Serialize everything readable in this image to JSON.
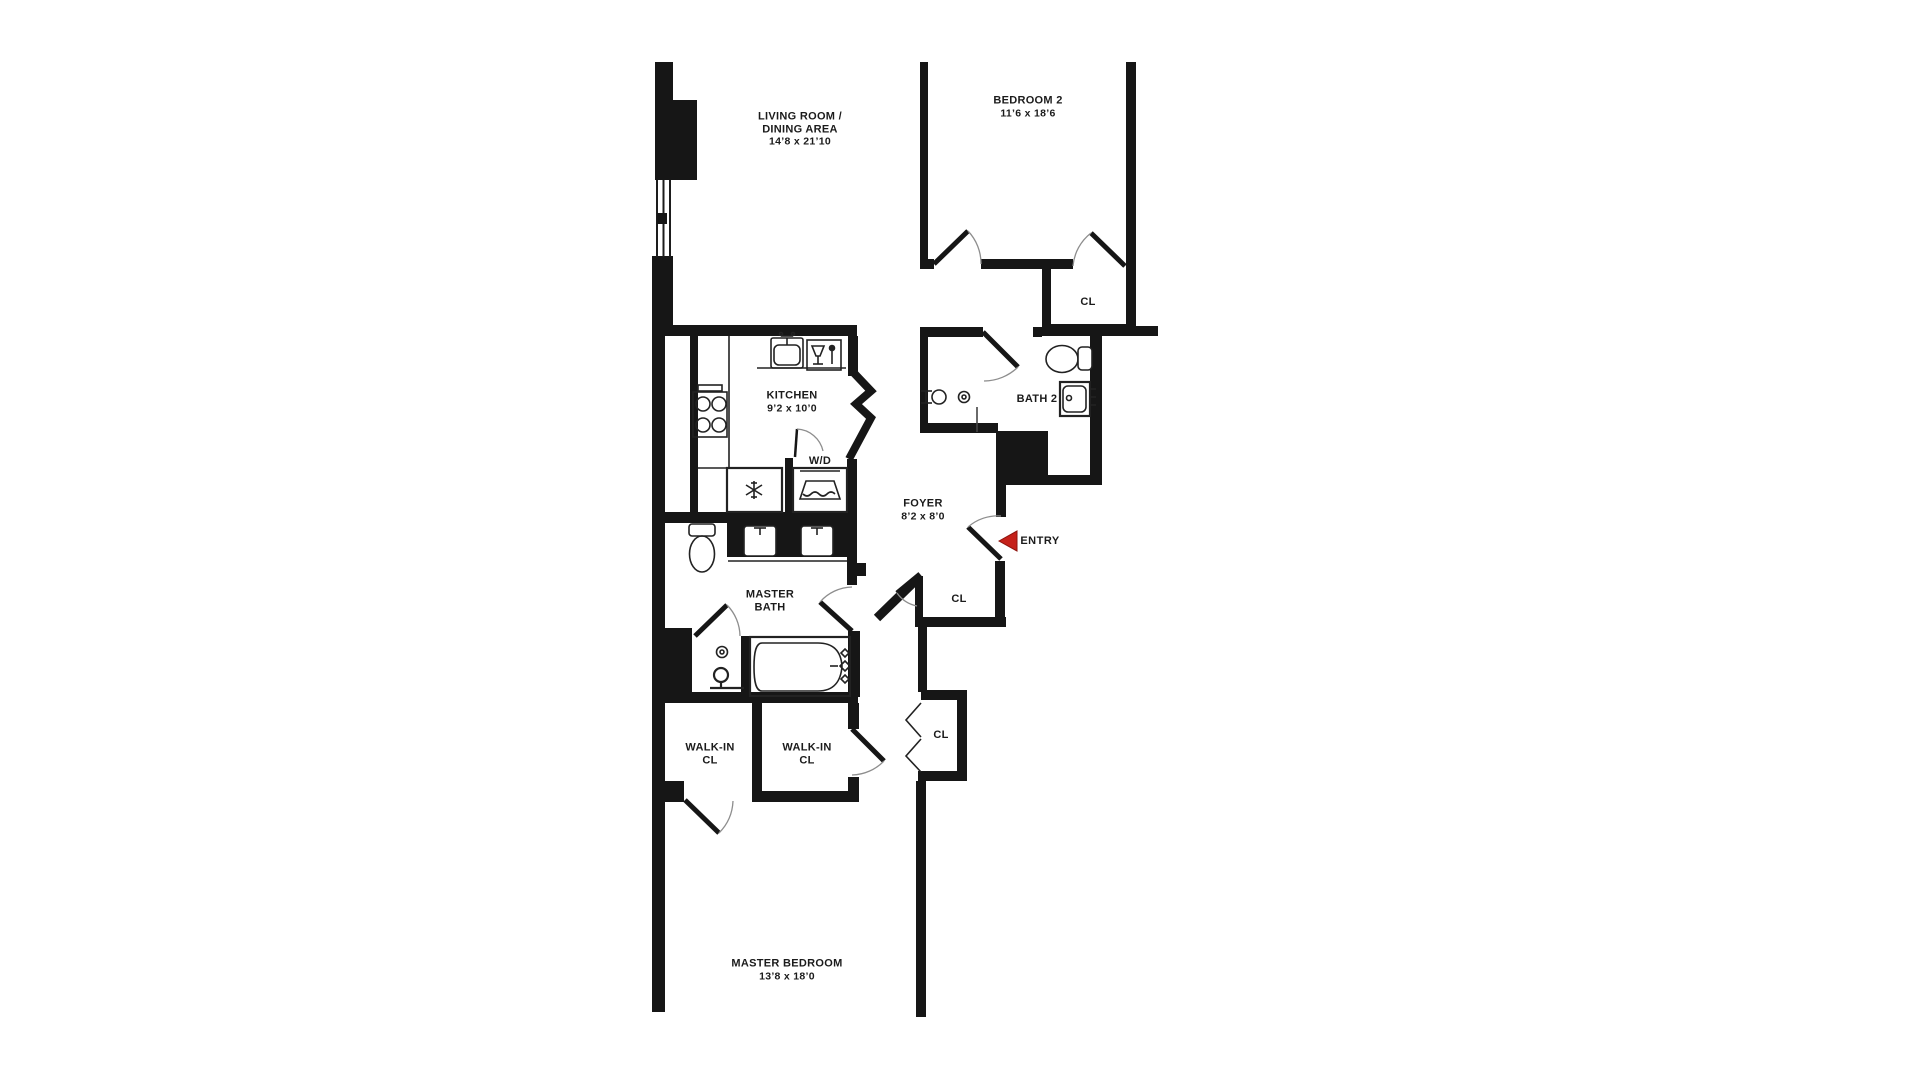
{
  "title": "Apartment floor plan",
  "colors": {
    "wall": "#161616",
    "paper": "#ffffff",
    "ink": "#1b1b1b",
    "arc": "#8d8d8d",
    "entry": "#c5211a"
  },
  "rooms": {
    "living_room": {
      "line1": "LIVING ROOM /",
      "line2": "DINING AREA",
      "dims": "14’8 x 21’10"
    },
    "bedroom2": {
      "name": "BEDROOM 2",
      "dims": "11’6 x 18’6"
    },
    "bedroom2_closet": {
      "name": "CL"
    },
    "kitchen": {
      "name": "KITCHEN",
      "dims": "9’2 x 10’0"
    },
    "laundry": {
      "name": "W/D"
    },
    "bath2": {
      "name": "BATH 2"
    },
    "foyer": {
      "name": "FOYER",
      "dims": "8’2 x 8’0"
    },
    "entry": {
      "name": "ENTRY"
    },
    "foyer_closet": {
      "name": "CL"
    },
    "master_bath": {
      "line1": "MASTER",
      "line2": "BATH"
    },
    "hall_closet": {
      "name": "CL"
    },
    "walkin_closet_left": {
      "line1": "WALK-IN",
      "line2": "CL"
    },
    "walkin_closet_right": {
      "line1": "WALK-IN",
      "line2": "CL"
    },
    "master_bedroom": {
      "name": "MASTER BEDROOM",
      "dims": "13’8 x 18’0"
    }
  }
}
